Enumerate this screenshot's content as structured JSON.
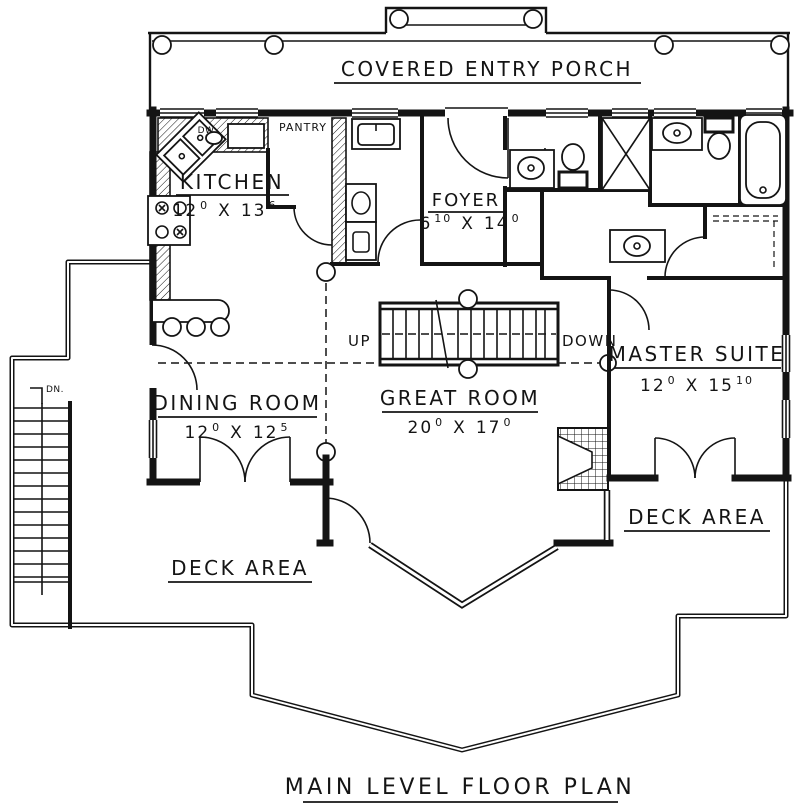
{
  "plan": {
    "title": "MAIN LEVEL FLOOR PLAN",
    "porch": {
      "label": "COVERED ENTRY PORCH"
    },
    "rooms": {
      "kitchen": {
        "name": "KITCHEN",
        "w": "12",
        "w_sup": "0",
        "x": "X",
        "l": "13",
        "l_sup": "6"
      },
      "foyer": {
        "name": "FOYER",
        "w": "6",
        "w_sup": "10",
        "x": "X",
        "l": "14",
        "l_sup": "0"
      },
      "dining_room": {
        "name": "DINING ROOM",
        "w": "12",
        "w_sup": "0",
        "x": "X",
        "l": "12",
        "l_sup": "5"
      },
      "great_room": {
        "name": "GREAT ROOM",
        "w": "20",
        "w_sup": "0",
        "x": "X",
        "l": "17",
        "l_sup": "0"
      },
      "master_suite": {
        "name": "MASTER SUITE",
        "w": "12",
        "w_sup": "0",
        "x": "X",
        "l": "15",
        "l_sup": "10"
      }
    },
    "labels": {
      "pantry": "PANTRY",
      "dishwasher": "DW",
      "stairs_up": "UP",
      "stairs_down": "DOWN",
      "stairs_dn": "DN.",
      "deck_left": "DECK AREA",
      "deck_right": "DECK AREA"
    },
    "colors": {
      "ink": "#141414",
      "paper": "#ffffff"
    }
  }
}
